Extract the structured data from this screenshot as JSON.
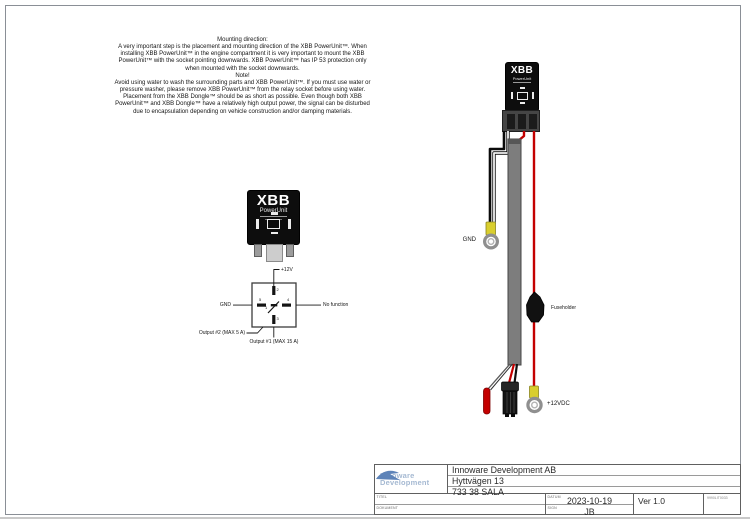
{
  "instructions": {
    "text": "Mounting direction:\nA very important step is the placement and mounting direction of the XBB PowerUnit™. When\ninstalling XBB PowerUnit™ in the engine compartment it is very important to mount the XBB\nPowerUnit™ with the socket pointing downwards. XBB PowerUnit™ has IP 53 protection only\nwhen mounted with the socket downwards.\nNote!\nAvoid using water to wash the surrounding parts and XBB PowerUnit™. If you must use water or\npressure washer, please remove XBB PowerUnit™ from the relay socket before using water.\nPlacement from the XBB Dongle™ should be as short as possible. Even though both XBB\nPowerUnit™ and XBB Dongle™ have a relatively high output power, the signal can be disturbed\ndue to encapsulation depending on vehicle construction and/or damping materials."
  },
  "device": {
    "brand": "XBB",
    "model": "PowerUnit"
  },
  "pinout": {
    "top_label": "+12V",
    "left_label": "GND",
    "right_label": "No function",
    "bottom_left_label": "Output #2 (MAX 5 A)",
    "bottom_label": "Output #1 (MAX 15 A)",
    "numbers": {
      "top": "2",
      "left": "5",
      "right": "4",
      "bottom": "3",
      "center": "1"
    }
  },
  "harness": {
    "gnd_label": "GND",
    "fuse_label": "Fuseholder",
    "power_label": "+12VDC"
  },
  "titleblock": {
    "logo_line1": "Innoware",
    "logo_line2": "Development",
    "company": "Innoware Development AB",
    "street": "Hyttvägen 13",
    "city": "733 38 SALA",
    "label_title": "TITEL",
    "label_document": "DOKUMENT",
    "label_date": "DATUM",
    "label_sign": "SIGN",
    "date": "2023-10-19",
    "sign": "JB",
    "version": "Ver 1.0",
    "ref": "9990LIT0033"
  }
}
